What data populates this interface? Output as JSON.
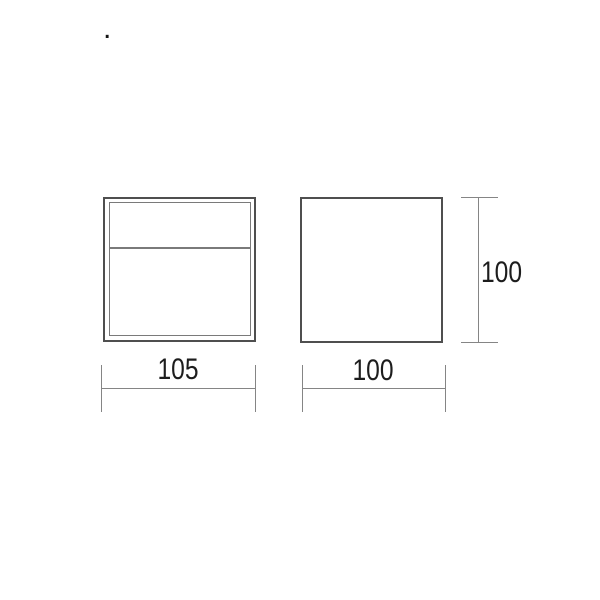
{
  "colors": {
    "background": "#ffffff",
    "object_line": "#4f4f4f",
    "inner_line": "#7a7a7a",
    "dimension_line": "#858585",
    "label_text": "#1d1d1d",
    "dot": "#141414"
  },
  "annotations": {
    "stray_dot": "."
  },
  "dimensions": {
    "left_view_width": {
      "label": "105"
    },
    "right_view_width": {
      "label": "100"
    },
    "right_view_height": {
      "label": "100"
    }
  }
}
